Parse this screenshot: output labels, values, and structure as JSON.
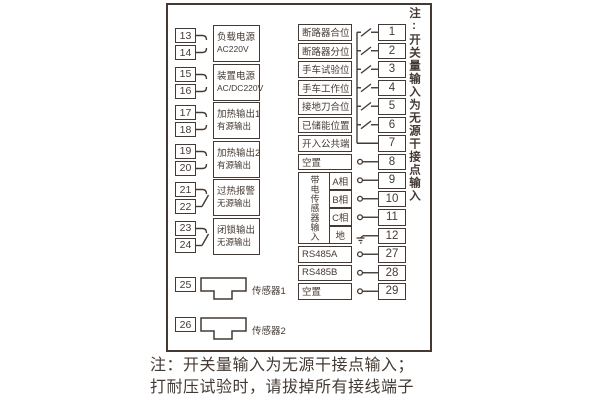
{
  "diagram": {
    "ink_color": "#453a33",
    "left_groups": [
      {
        "terminals": [
          "13",
          "14"
        ],
        "label_line1": "负载电源",
        "label_line2": "AC220V",
        "connector": "plug"
      },
      {
        "terminals": [
          "15",
          "16"
        ],
        "label_line1": "装置电源",
        "label_line2": "AC/DC220V",
        "connector": "plug"
      },
      {
        "terminals": [
          "17",
          "18"
        ],
        "label_line1": "加热输出1",
        "label_line2": "有源输出",
        "connector": "plug"
      },
      {
        "terminals": [
          "19",
          "20"
        ],
        "label_line1": "加热输出2",
        "label_line2": "有源输出",
        "connector": "plug"
      },
      {
        "terminals": [
          "21",
          "22"
        ],
        "label_line1": "过热报警",
        "label_line2": "无源输出",
        "connector": "contact"
      },
      {
        "terminals": [
          "23",
          "24"
        ],
        "label_line1": "闭锁输出",
        "label_line2": "无源输出",
        "connector": "contact"
      }
    ],
    "sensors": [
      {
        "terminal": "25",
        "label": "传感器1"
      },
      {
        "terminal": "26",
        "label": "传感器2"
      }
    ],
    "right_rows": [
      {
        "label": "断路器合位",
        "terminal": "1",
        "symbol": "contact"
      },
      {
        "label": "断路器分位",
        "terminal": "2",
        "symbol": "contact"
      },
      {
        "label": "手车试验位",
        "terminal": "3",
        "symbol": "contact"
      },
      {
        "label": "手车工作位",
        "terminal": "4",
        "symbol": "contact"
      },
      {
        "label": "接地刀合位",
        "terminal": "5",
        "symbol": "contact"
      },
      {
        "label": "已储能位置",
        "terminal": "6",
        "symbol": "contact"
      },
      {
        "label": "开入公共端",
        "terminal": "7",
        "symbol": "line"
      },
      {
        "label": "空置",
        "terminal": "8",
        "symbol": "circle"
      },
      {
        "label": "A相",
        "terminal": "9",
        "symbol": "circle"
      },
      {
        "label": "B相",
        "terminal": "10",
        "symbol": "circle"
      },
      {
        "label": "C相",
        "terminal": "11",
        "symbol": "circle"
      },
      {
        "label": "地",
        "terminal": "12",
        "symbol": "ground"
      },
      {
        "label": "RS485A",
        "terminal": "27",
        "symbol": "circle"
      },
      {
        "label": "RS485B",
        "terminal": "28",
        "symbol": "circle"
      },
      {
        "label": "空置",
        "terminal": "29",
        "symbol": "circle"
      }
    ],
    "sensor_group_label": "带电传感器输入",
    "side_note": "注:开关量输入为无源干接点输入",
    "footer_line1": "注：开关量输入为无源干接点输入；",
    "footer_line2": "打耐压试验时，请拔掉所有接线端子"
  }
}
